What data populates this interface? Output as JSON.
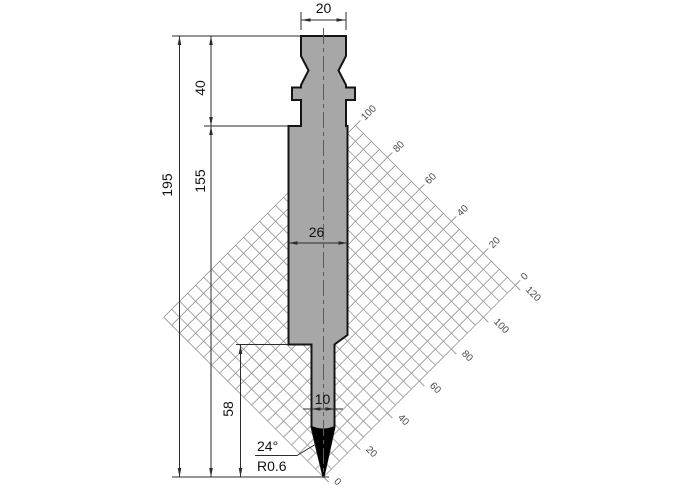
{
  "drawing": {
    "type": "technical-drawing",
    "subject": "press-brake-punch-cross-section",
    "dimensions": {
      "top_width": "20",
      "head_height": "40",
      "total_height": "195",
      "lower_height": "155",
      "body_width": "26",
      "tip_section_height": "58",
      "shank_width": "10",
      "tip_angle": "24°",
      "tip_radius": "R0.6"
    },
    "grid": {
      "x_labels": [
        "0",
        "20",
        "40",
        "60",
        "80",
        "100",
        "120"
      ],
      "y_labels": [
        "0",
        "20",
        "40",
        "60",
        "80",
        "100"
      ],
      "cell_px": 11.3,
      "x_cells": 24,
      "y_cells": 20,
      "tick_every_cells": 4,
      "rotation_deg": -45
    },
    "colors": {
      "background": "#ffffff",
      "punch_fill": "#a7a7a7",
      "outline": "#141414",
      "dim_line": "#2b2b2b",
      "grid_line": "#909090",
      "grid_label": "#4a4a4a",
      "tip_fill": "#000000"
    }
  }
}
